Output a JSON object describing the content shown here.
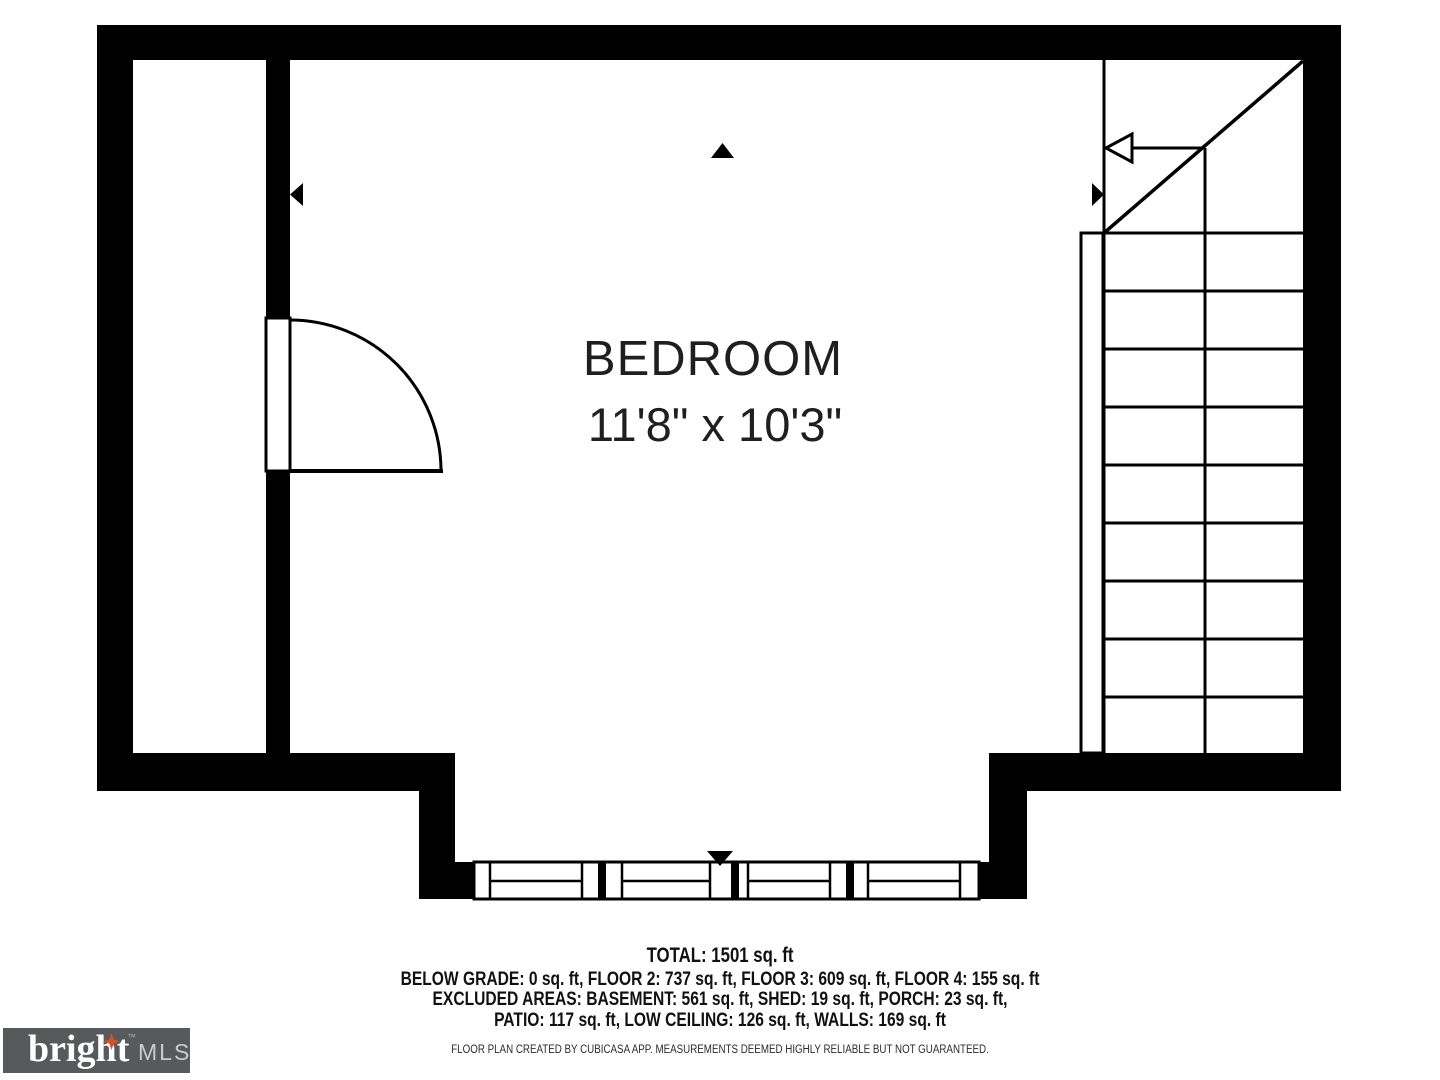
{
  "plan": {
    "room_name": "BEDROOM",
    "room_dimensions": "11'8\" x 10'3\""
  },
  "summary": {
    "total": "TOTAL: 1501 sq. ft",
    "floors": "BELOW GRADE: 0 sq. ft, FLOOR 2: 737 sq. ft, FLOOR 3: 609 sq. ft, FLOOR 4: 155 sq. ft",
    "excluded_line1": "EXCLUDED AREAS: BASEMENT: 561 sq. ft, SHED: 19 sq. ft, PORCH: 23 sq. ft,",
    "excluded_line2": "PATIO: 117 sq. ft, LOW CEILING: 126 sq. ft, WALLS: 169 sq. ft"
  },
  "footer": {
    "disclaimer": "FLOOR PLAN CREATED BY CUBICASA APP. MEASUREMENTS DEEMED HIGHLY RELIABLE BUT NOT GUARANTEED."
  },
  "logo": {
    "brand": "bright",
    "trademark": "™",
    "suffix": "MLS"
  },
  "icons": {
    "up_marker": "triangle-up",
    "left_marker": "triangle-left",
    "right_marker": "triangle-right",
    "window_marker": "triangle-down",
    "stair_direction": "arrow-left"
  },
  "colors": {
    "wall": "#000000",
    "background": "#FFFFFF",
    "logo_bg": "#58595B",
    "logo_star": "#D4502F",
    "logo_brand_text": "#FFFFFF",
    "logo_suffix_text": "#CCCBC9"
  }
}
